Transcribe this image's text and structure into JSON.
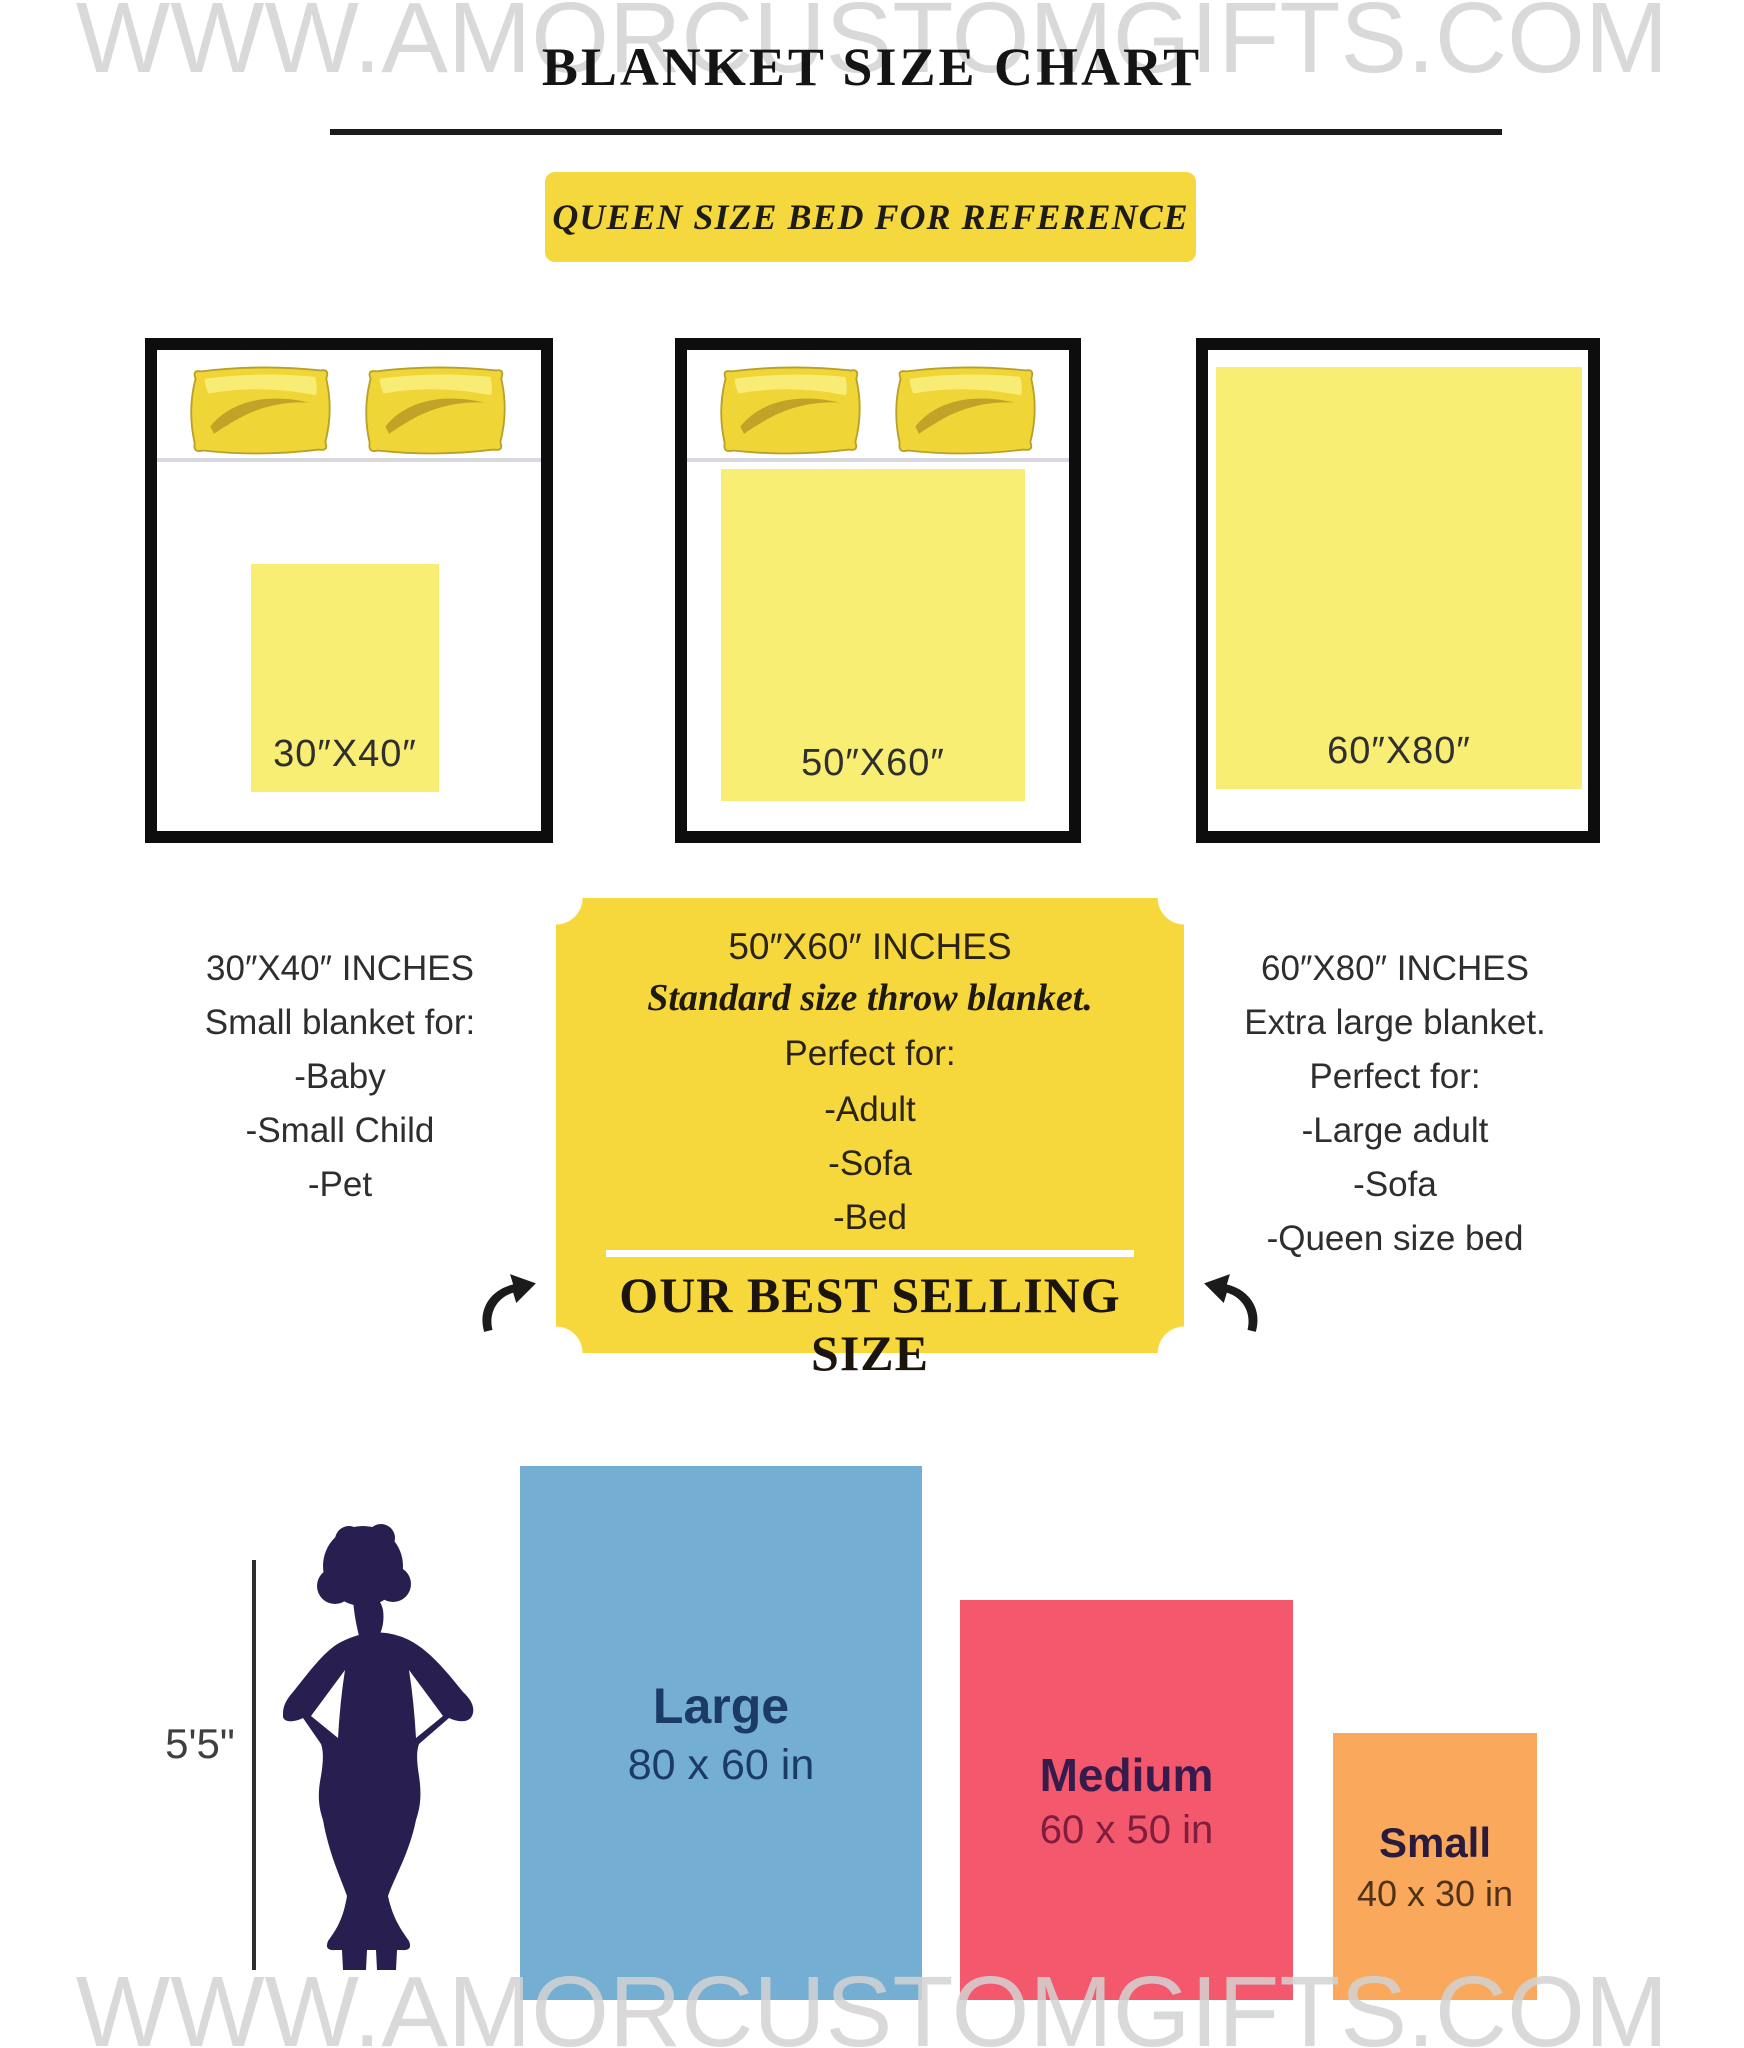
{
  "page": {
    "watermark": "WWW.AMORCUSTOMGIFTS.COM",
    "title": "BLANKET SIZE CHART",
    "reference_banner": "QUEEN SIZE BED FOR REFERENCE"
  },
  "colors": {
    "banner_yellow": "#F5D73E",
    "ticket_yellow": "#F6D73C",
    "blanket_yellow": "#F9EE74",
    "bed_border": "#0d0d0d",
    "watermark_gray": "#d2d2d2",
    "large_blue": "#74AFD3",
    "medium_pink": "#F4586C",
    "small_orange": "#F9A85C",
    "silhouette_navy": "#281F50"
  },
  "beds": [
    {
      "blanket_label": "30″X40″"
    },
    {
      "blanket_label": "50″X60″"
    },
    {
      "blanket_label": "60″X80″"
    }
  ],
  "columns": {
    "left": {
      "title": "30″X40″ INCHES",
      "subtitle": "Small blanket for:",
      "items": [
        "-Baby",
        "-Small Child",
        "-Pet"
      ]
    },
    "center": {
      "title": "50″X60″ INCHES",
      "subtitle": "Standard size throw blanket.",
      "lead": "Perfect for:",
      "items": [
        "-Adult",
        "-Sofa",
        "-Bed"
      ],
      "footer": "OUR BEST SELLING SIZE"
    },
    "right": {
      "title": "60″X80″ INCHES",
      "subtitle": "Extra large blanket.",
      "lead": "Perfect for:",
      "items": [
        "-Large adult",
        "-Sofa",
        "-Queen size bed"
      ]
    }
  },
  "comparison": {
    "height_label": "5'5\"",
    "sizes": [
      {
        "name": "Large",
        "dims": "80 x 60 in",
        "color": "#74AFD3"
      },
      {
        "name": "Medium",
        "dims": "60 x 50 in",
        "color": "#F4586C"
      },
      {
        "name": "Small",
        "dims": "40 x 30 in",
        "color": "#F9A85C"
      }
    ]
  }
}
